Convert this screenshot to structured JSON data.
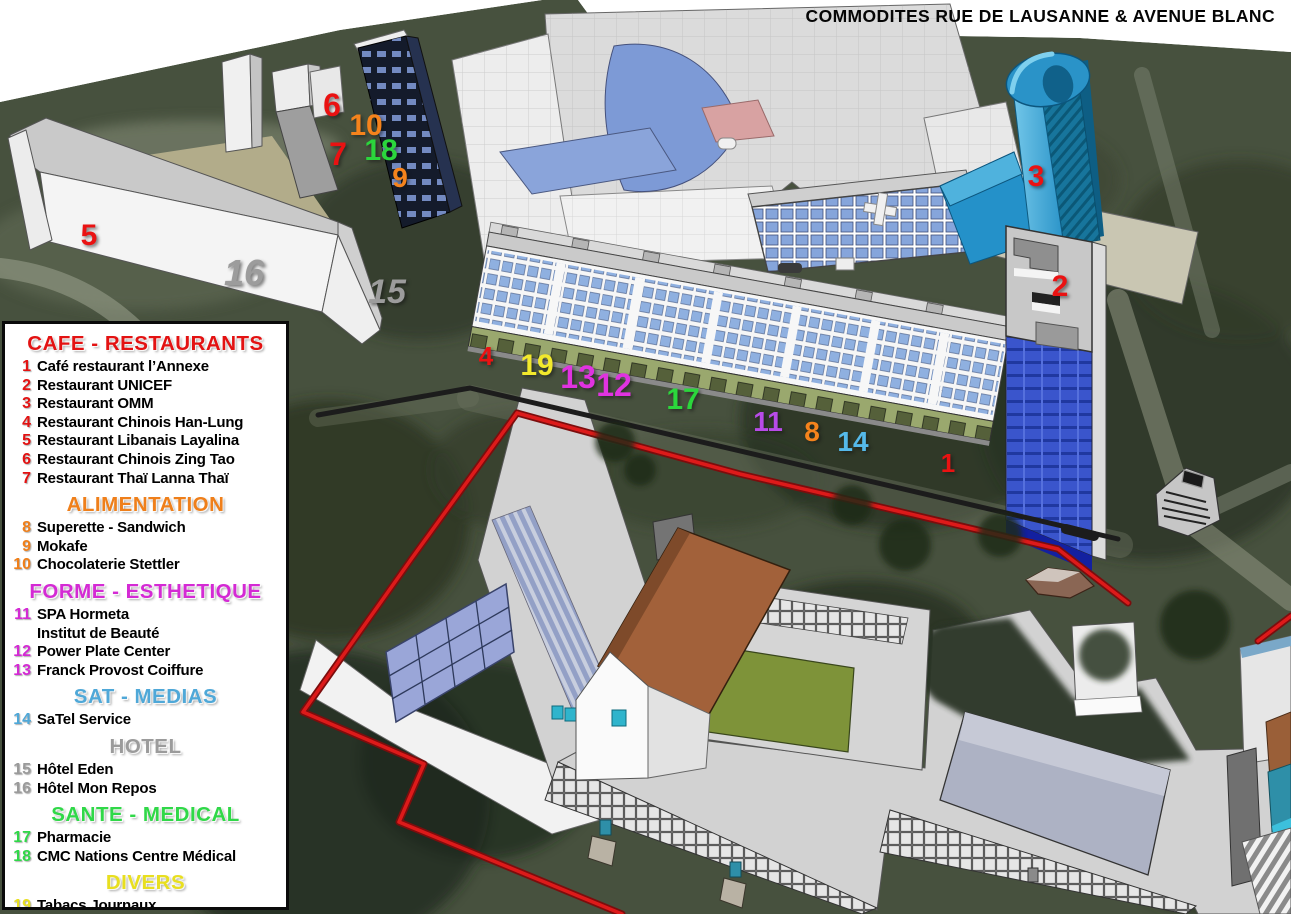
{
  "title": "COMMODITES RUE DE LAUSANNE & AVENUE BLANC",
  "legend": {
    "sections": [
      {
        "name": "CAFE - RESTAURANTS",
        "color": "#e31212",
        "items": [
          {
            "num": "1",
            "label": "Café restaurant l’Annexe"
          },
          {
            "num": "2",
            "label": "Restaurant UNICEF"
          },
          {
            "num": "3",
            "label": "Restaurant OMM"
          },
          {
            "num": "4",
            "label": "Restaurant Chinois Han-Lung"
          },
          {
            "num": "5",
            "label": "Restaurant Libanais Layalina"
          },
          {
            "num": "6",
            "label": "Restaurant Chinois Zing Tao"
          },
          {
            "num": "7",
            "label": "Restaurant Thaï Lanna Thaï"
          }
        ]
      },
      {
        "name": "ALIMENTATION",
        "color": "#ef7f1a",
        "items": [
          {
            "num": "8",
            "label": "Superette - Sandwich"
          },
          {
            "num": "9",
            "label": "Mokafe"
          },
          {
            "num": "10",
            "label": "Chocolaterie Stettler"
          }
        ]
      },
      {
        "name": "FORME - ESTHETIQUE",
        "color": "#d42ad4",
        "items": [
          {
            "num": "11",
            "label": "SPA Hormeta",
            "sub": "Institut de Beauté"
          },
          {
            "num": "12",
            "label": "Power Plate Center"
          },
          {
            "num": "13",
            "label": "Franck Provost Coiffure"
          }
        ]
      },
      {
        "name": "SAT - MEDIAS",
        "color": "#4fa8d8",
        "items": [
          {
            "num": "14",
            "label": "SaTel Service"
          }
        ]
      },
      {
        "name": "HOTEL",
        "color": "#9b9b9b",
        "items": [
          {
            "num": "15",
            "label": "Hôtel Eden"
          },
          {
            "num": "16",
            "label": "Hôtel Mon Repos"
          }
        ]
      },
      {
        "name": "SANTE - MEDICAL",
        "color": "#30d848",
        "items": [
          {
            "num": "17",
            "label": "Pharmacie"
          },
          {
            "num": "18",
            "label": "CMC Nations Centre Médical"
          }
        ]
      },
      {
        "name": "DIVERS",
        "color": "#e8df20",
        "items": [
          {
            "num": "19",
            "label": "Tabacs Journaux"
          }
        ]
      }
    ]
  },
  "map_markers": [
    {
      "num": "1",
      "x": 948,
      "y": 463,
      "color": "#ea1212",
      "size": 26
    },
    {
      "num": "2",
      "x": 1060,
      "y": 287,
      "color": "#ea1212",
      "size": 30
    },
    {
      "num": "3",
      "x": 1036,
      "y": 177,
      "color": "#ea1212",
      "size": 30
    },
    {
      "num": "4",
      "x": 486,
      "y": 356,
      "color": "#ea1212",
      "size": 26
    },
    {
      "num": "5",
      "x": 89,
      "y": 236,
      "color": "#ea1212",
      "size": 30
    },
    {
      "num": "6",
      "x": 332,
      "y": 105,
      "color": "#ea1212",
      "size": 32
    },
    {
      "num": "7",
      "x": 338,
      "y": 154,
      "color": "#ea1212",
      "size": 32
    },
    {
      "num": "8",
      "x": 812,
      "y": 432,
      "color": "#f5831c",
      "size": 28
    },
    {
      "num": "9",
      "x": 400,
      "y": 178,
      "color": "#f5831c",
      "size": 28
    },
    {
      "num": "10",
      "x": 366,
      "y": 126,
      "color": "#f5831c",
      "size": 30
    },
    {
      "num": "11",
      "x": 768,
      "y": 422,
      "color": "#b84be8",
      "size": 28
    },
    {
      "num": "12",
      "x": 614,
      "y": 385,
      "color": "#e033e0",
      "size": 32
    },
    {
      "num": "13",
      "x": 578,
      "y": 377,
      "color": "#e033e0",
      "size": 32
    },
    {
      "num": "14",
      "x": 853,
      "y": 442,
      "color": "#55b9ea",
      "size": 28
    },
    {
      "num": "15",
      "x": 387,
      "y": 292,
      "color": "#9c9c9c",
      "size": 34,
      "italic": true
    },
    {
      "num": "16",
      "x": 244,
      "y": 273,
      "color": "#9c9c9c",
      "size": 36,
      "italic": true
    },
    {
      "num": "17",
      "x": 683,
      "y": 400,
      "color": "#2bd63c",
      "size": 30
    },
    {
      "num": "18",
      "x": 381,
      "y": 151,
      "color": "#2bd63c",
      "size": 30
    },
    {
      "num": "19",
      "x": 537,
      "y": 366,
      "color": "#f2e92c",
      "size": 30
    }
  ]
}
